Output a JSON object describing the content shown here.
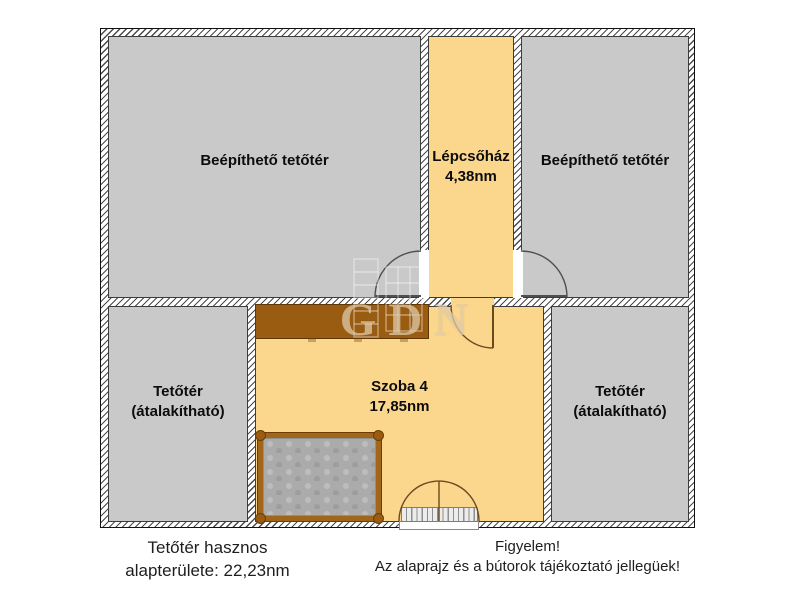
{
  "plan": {
    "rooms": [
      {
        "name": "Beépíthető tetőtér",
        "fill": "#c9c9c9"
      },
      {
        "name": "Lépcsőház",
        "area": "4,38nm",
        "fill": "#fbd78e"
      },
      {
        "name": "Beépíthető tetőtér",
        "fill": "#c9c9c9"
      },
      {
        "name": "Tetőtér",
        "note": "(átalakítható)",
        "fill": "#c9c9c9"
      },
      {
        "name": "Szoba 4",
        "area": "17,85nm",
        "fill": "#fbd78e"
      },
      {
        "name": "Tetőtér",
        "note": "(átalakítható)",
        "fill": "#c9c9c9"
      }
    ],
    "watermark": {
      "text": "GDN"
    },
    "colors": {
      "room_gray": "#c9c9c9",
      "room_orange": "#fbd78e",
      "wardrobe_brown": "#9a5c10",
      "bed_frame_brown": "#a2661b",
      "mattress_gray": "#ababab",
      "wall_line": "#4a4a4a"
    }
  },
  "footer": {
    "left": {
      "line1": "Tetőtér hasznos",
      "line2": "alapterülete: 22,23nm"
    },
    "notice": {
      "line1": "Figyelem!",
      "line2": "Az alaprajz és a bútorok tájékoztató jellegüek!"
    }
  }
}
